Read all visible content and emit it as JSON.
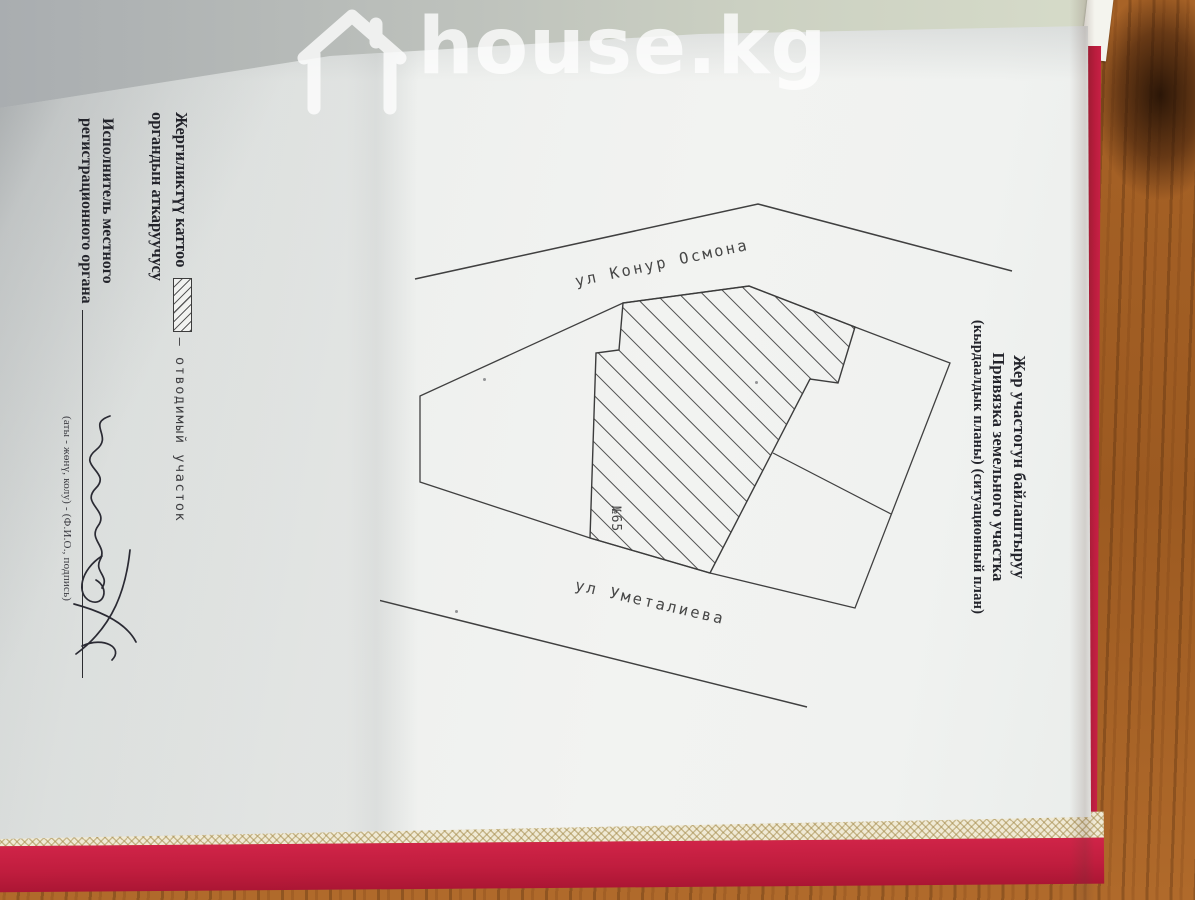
{
  "watermark": {
    "text": "house.kg",
    "icon": "house-outline-icon"
  },
  "title": {
    "line1": "Жер участогун байлаштыруу",
    "line2": "Привязка земельного участка",
    "line3": "(кырдаалдык планы) (ситуационный план)"
  },
  "legend": {
    "line1_prefix": "Жергиликтүү каттоо",
    "symbol": "hatched-rectangle",
    "symbol_label": "— отводимый участок",
    "line2": "органдын аткаруучусу"
  },
  "executor": {
    "line1": "Исполнитель местного",
    "line2": "регистрационного органа",
    "caption": "(аты - жөнү, колу) - (Ф.И.О., подпись)",
    "signature": "handwritten-signature"
  },
  "site_plan": {
    "street_top": "ул Конур Осмона",
    "street_bottom": "ул Уметалиева",
    "parcel_number": "№65",
    "allocated_parcel_style": "diagonal-hatch"
  },
  "colors": {
    "book_cover_red": "#c01d3e",
    "cover_trim_cream": "#f0ead5",
    "wood_table": "#9c5a21",
    "paper": "#eef0ee",
    "drawing_line": "#404040",
    "watermark_white": "#ffffff"
  }
}
